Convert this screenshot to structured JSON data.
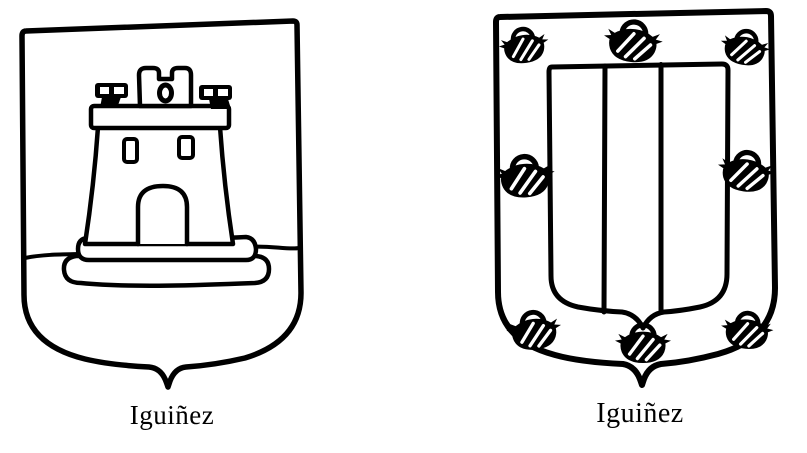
{
  "page": {
    "background": "#ffffff",
    "ink": "#000000",
    "kind": "scanned-heraldry-book-plate"
  },
  "figures": [
    {
      "label": "Iguiñez",
      "icon": "castle-shield-icon",
      "motif": "castle on a mound above a ground line"
    },
    {
      "label": "Iguiñez",
      "icon": "pales-and-cauldrons-shield-icon",
      "motif": "inner escutcheon of three pales within a bordure of cauldrons",
      "pale_count": 3,
      "cauldron_count": 8
    }
  ]
}
